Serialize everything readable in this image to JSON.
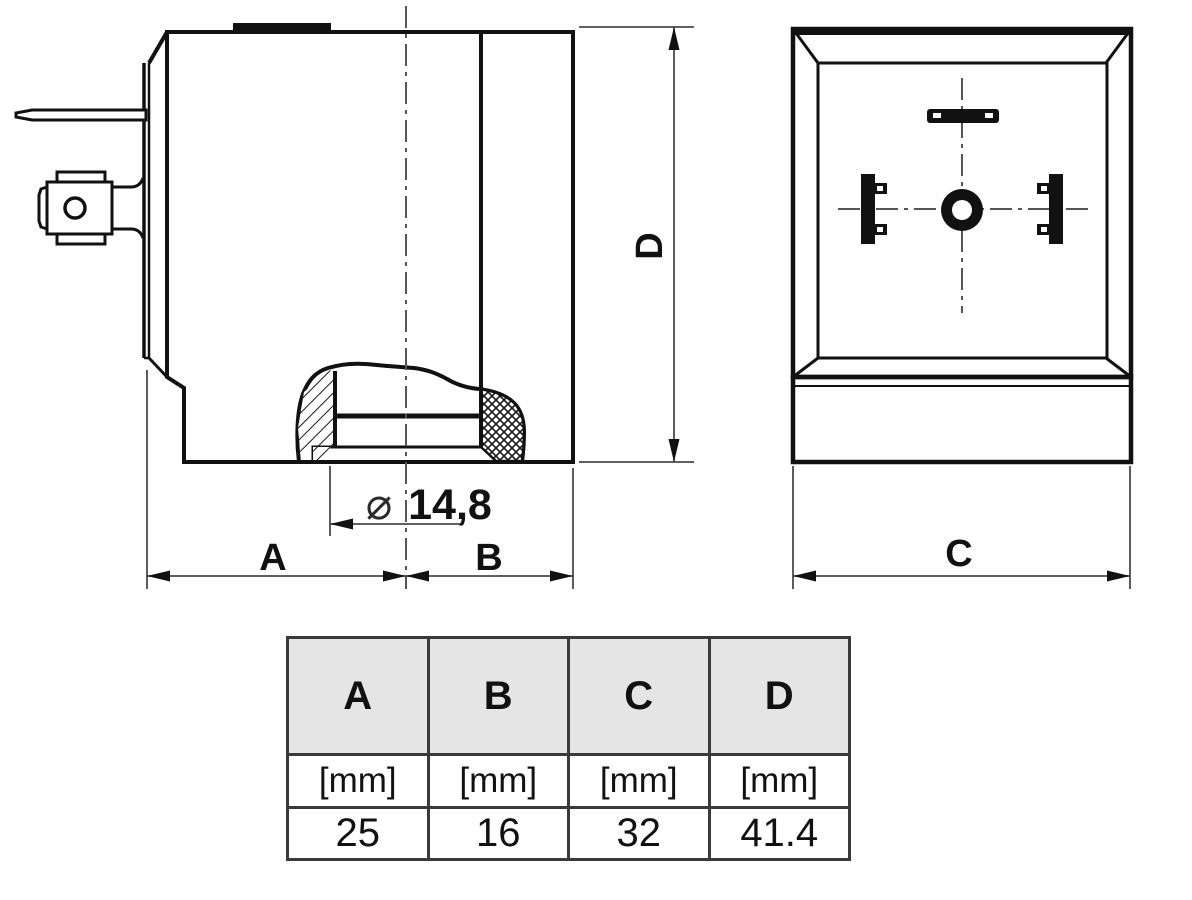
{
  "drawing": {
    "dim_a": "A",
    "dim_b": "B",
    "dim_c": "C",
    "dim_d": "D",
    "diameter_symbol": "⌀",
    "diameter_value": "14,8"
  },
  "table": {
    "headers": [
      "A",
      "B",
      "C",
      "D"
    ],
    "units": [
      "[mm]",
      "[mm]",
      "[mm]",
      "[mm]"
    ],
    "values": [
      "25",
      "16",
      "32",
      "41.4"
    ]
  },
  "colors": {
    "line": "#111111",
    "thin_line": "#4a4a4a",
    "table_border": "#3a3a3a",
    "table_header_fill": "#e5e5e5",
    "background": "#ffffff"
  }
}
